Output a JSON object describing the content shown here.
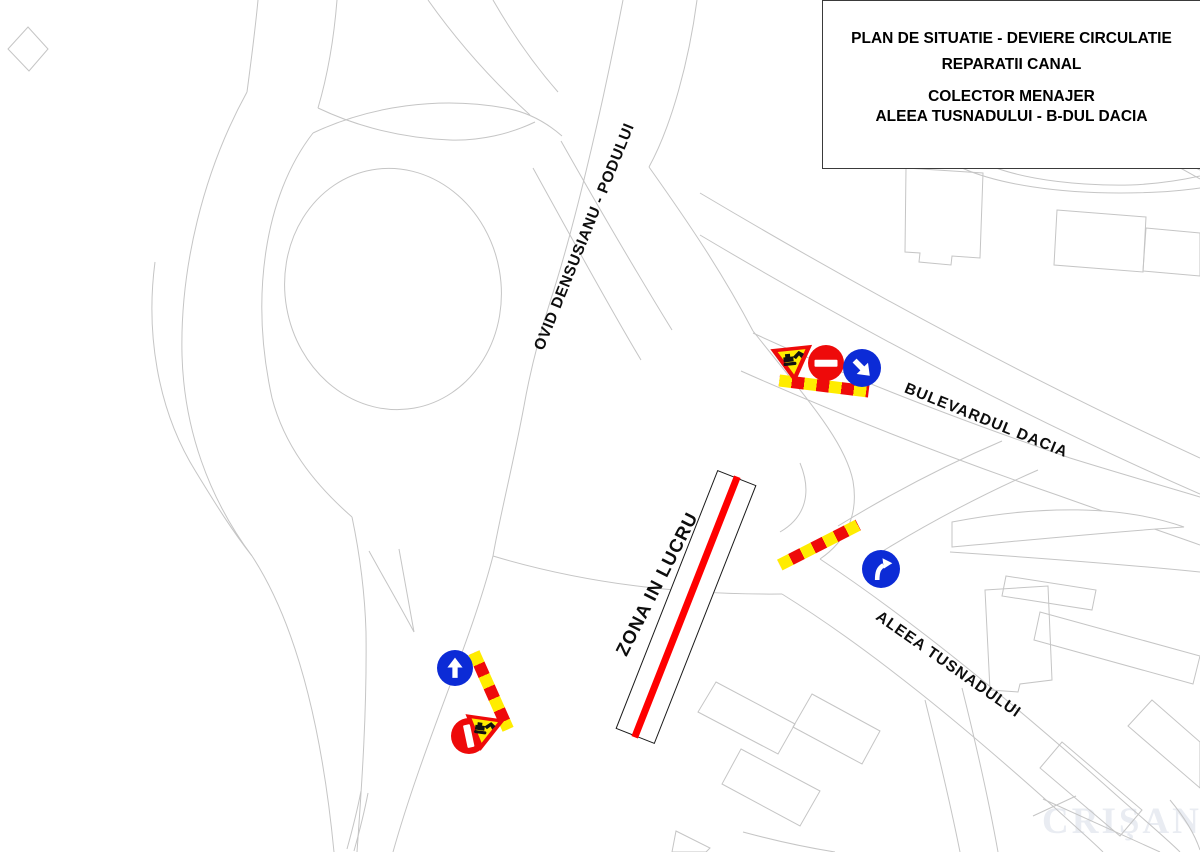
{
  "title_block": {
    "lines": [
      "PLAN DE SITUATIE - DEVIERE CIRCULATIE",
      "REPARATII CANAL",
      "COLECTOR MENAJER",
      "ALEEA TUSNADULUI - B-DUL DACIA"
    ]
  },
  "road_labels": {
    "ovid": "OVID DENSUSIANU - PODULUI",
    "dacia": "BULEVARDUL DACIA",
    "tusnadului": "ALEEA TUSNADULUI",
    "work_zone": "ZONA IN LUCRU"
  },
  "watermark": {
    "text": "CRIŞANA"
  },
  "colors": {
    "sign_red": "#ee0a0a",
    "sign_blue": "#0c2bd6",
    "barrier_yellow": "#ffec00",
    "work_line_red": "#ff0000",
    "work_outline": "#1a1a1a",
    "map_line": "#c5c5c5"
  },
  "signs": {
    "group_dacia": [
      "roadworks-yield-sign",
      "no-entry-sign",
      "mandatory-direction-down-right-sign",
      "striped-barrier-board"
    ],
    "group_tusnadului": [
      "striped-barrier-board",
      "turn-right-ahead-sign"
    ],
    "group_south": [
      "straight-ahead-sign",
      "no-entry-sign",
      "striped-barrier-board",
      "roadworks-yield-sign"
    ]
  }
}
